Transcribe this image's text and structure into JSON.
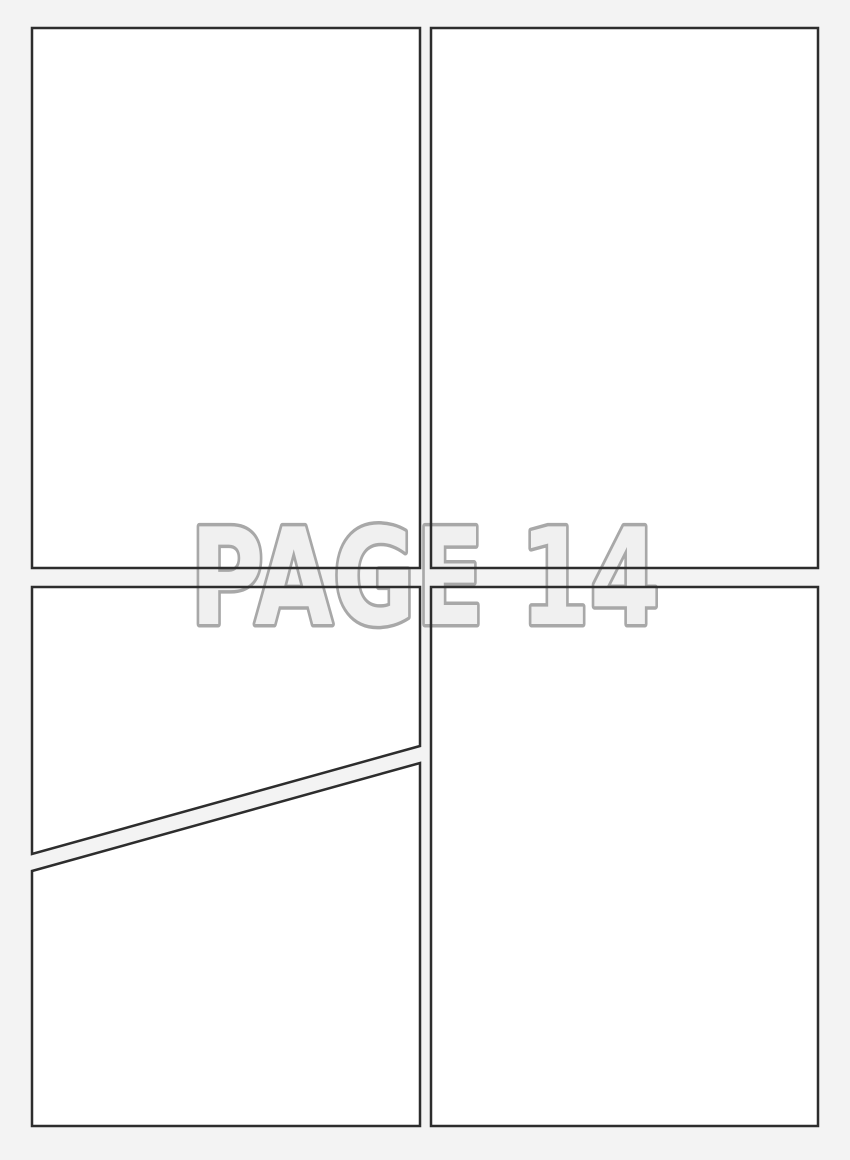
{
  "page": {
    "watermark_label": "PAGE 14"
  },
  "colors": {
    "background": "#f3f3f3",
    "panel_fill": "#ffffff",
    "panel_border": "#2d2d2d",
    "watermark_fill": "#f0f0f0",
    "watermark_outline": "#a8a8a8"
  },
  "panels": [
    {
      "name": "top-left-panel"
    },
    {
      "name": "top-right-panel"
    },
    {
      "name": "bottom-left-upper-panel"
    },
    {
      "name": "bottom-left-lower-panel"
    },
    {
      "name": "bottom-right-panel"
    }
  ]
}
